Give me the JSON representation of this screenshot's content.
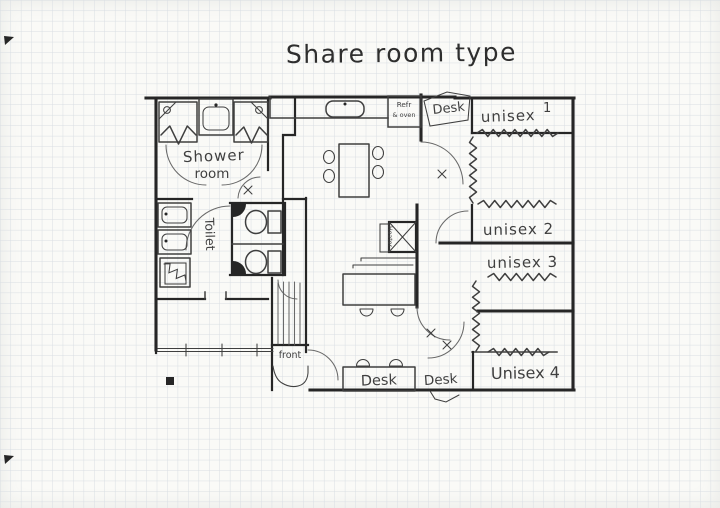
{
  "title": "Share room type",
  "rooms": {
    "shower_line1": "Shower",
    "shower_line2": "room",
    "toilet": "Toilet",
    "unisex1_label": "unisex",
    "unisex1_number": "1",
    "unisex2": "unisex 2",
    "unisex3": "unisex 3",
    "unisex4": "Unisex 4",
    "front": "front"
  },
  "fixtures": {
    "refr_line1": "Refr",
    "refr_line2": "& oven",
    "heater": "Heater",
    "desk_top": "Desk",
    "desk_bottom_center": "Desk",
    "desk_bottom_right": "Desk"
  },
  "colors": {
    "paper": "#fafaf7",
    "grid": "#d9dee3",
    "ink": "#3f3f3f",
    "wall": "#262626"
  }
}
